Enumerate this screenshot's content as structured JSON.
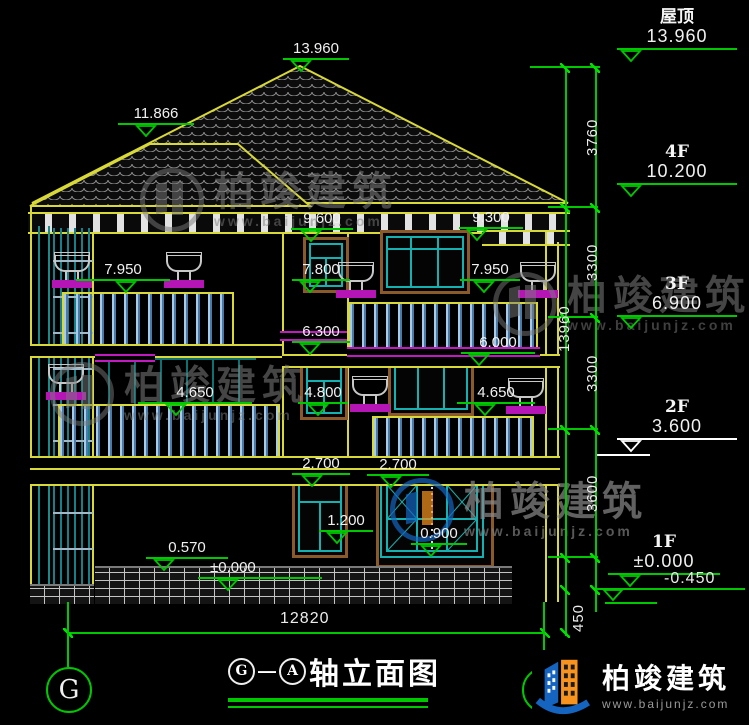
{
  "drawing": {
    "axis_left": "G",
    "axis_right": "A",
    "dash": "—",
    "title_text": "轴立面图",
    "overall_width_dim": "12820"
  },
  "right_column": {
    "floors": [
      {
        "label": "屋顶",
        "value": "13.960"
      },
      {
        "label": "4F",
        "value": "10.200"
      },
      {
        "label": "3F",
        "value": "6.900"
      },
      {
        "label": "2F",
        "value": "3.600"
      },
      {
        "label": "1F",
        "value": "±0.000"
      }
    ],
    "below_ground": "-0.450",
    "segment_dims": [
      "3760",
      "3300",
      "3300",
      "3600",
      "450"
    ],
    "total_dim": "13960"
  },
  "marks": {
    "roof_apex": "13.960",
    "ridge_left": "11.866",
    "eave_left": "9.600",
    "eave_right": "9.300",
    "balcony3_left": "7.950",
    "window3_mid": "7.800",
    "balcony3_right": "7.950",
    "band_left": "6.300",
    "band_right": "6.000",
    "balcony2_left": "4.650",
    "window2_mid": "4.800",
    "balcony2_right": "4.650",
    "slab_left": "2.700",
    "slab_right": "2.700",
    "window1_small": "1.200",
    "window1_large": "0.900",
    "ledge": "0.570",
    "ground": "±0.000"
  },
  "brand": {
    "name": "柏竣建筑",
    "url": "www.baijunjz.com"
  },
  "colors": {
    "dim_green": "#00c800",
    "outline_yellow": "#d8d838",
    "band_magenta": "#c01ac0",
    "frame_teal": "#15b0b0",
    "surround_brown": "#8a5a2b",
    "logo_blue": "#1565c0",
    "logo_orange": "#f7931e"
  }
}
